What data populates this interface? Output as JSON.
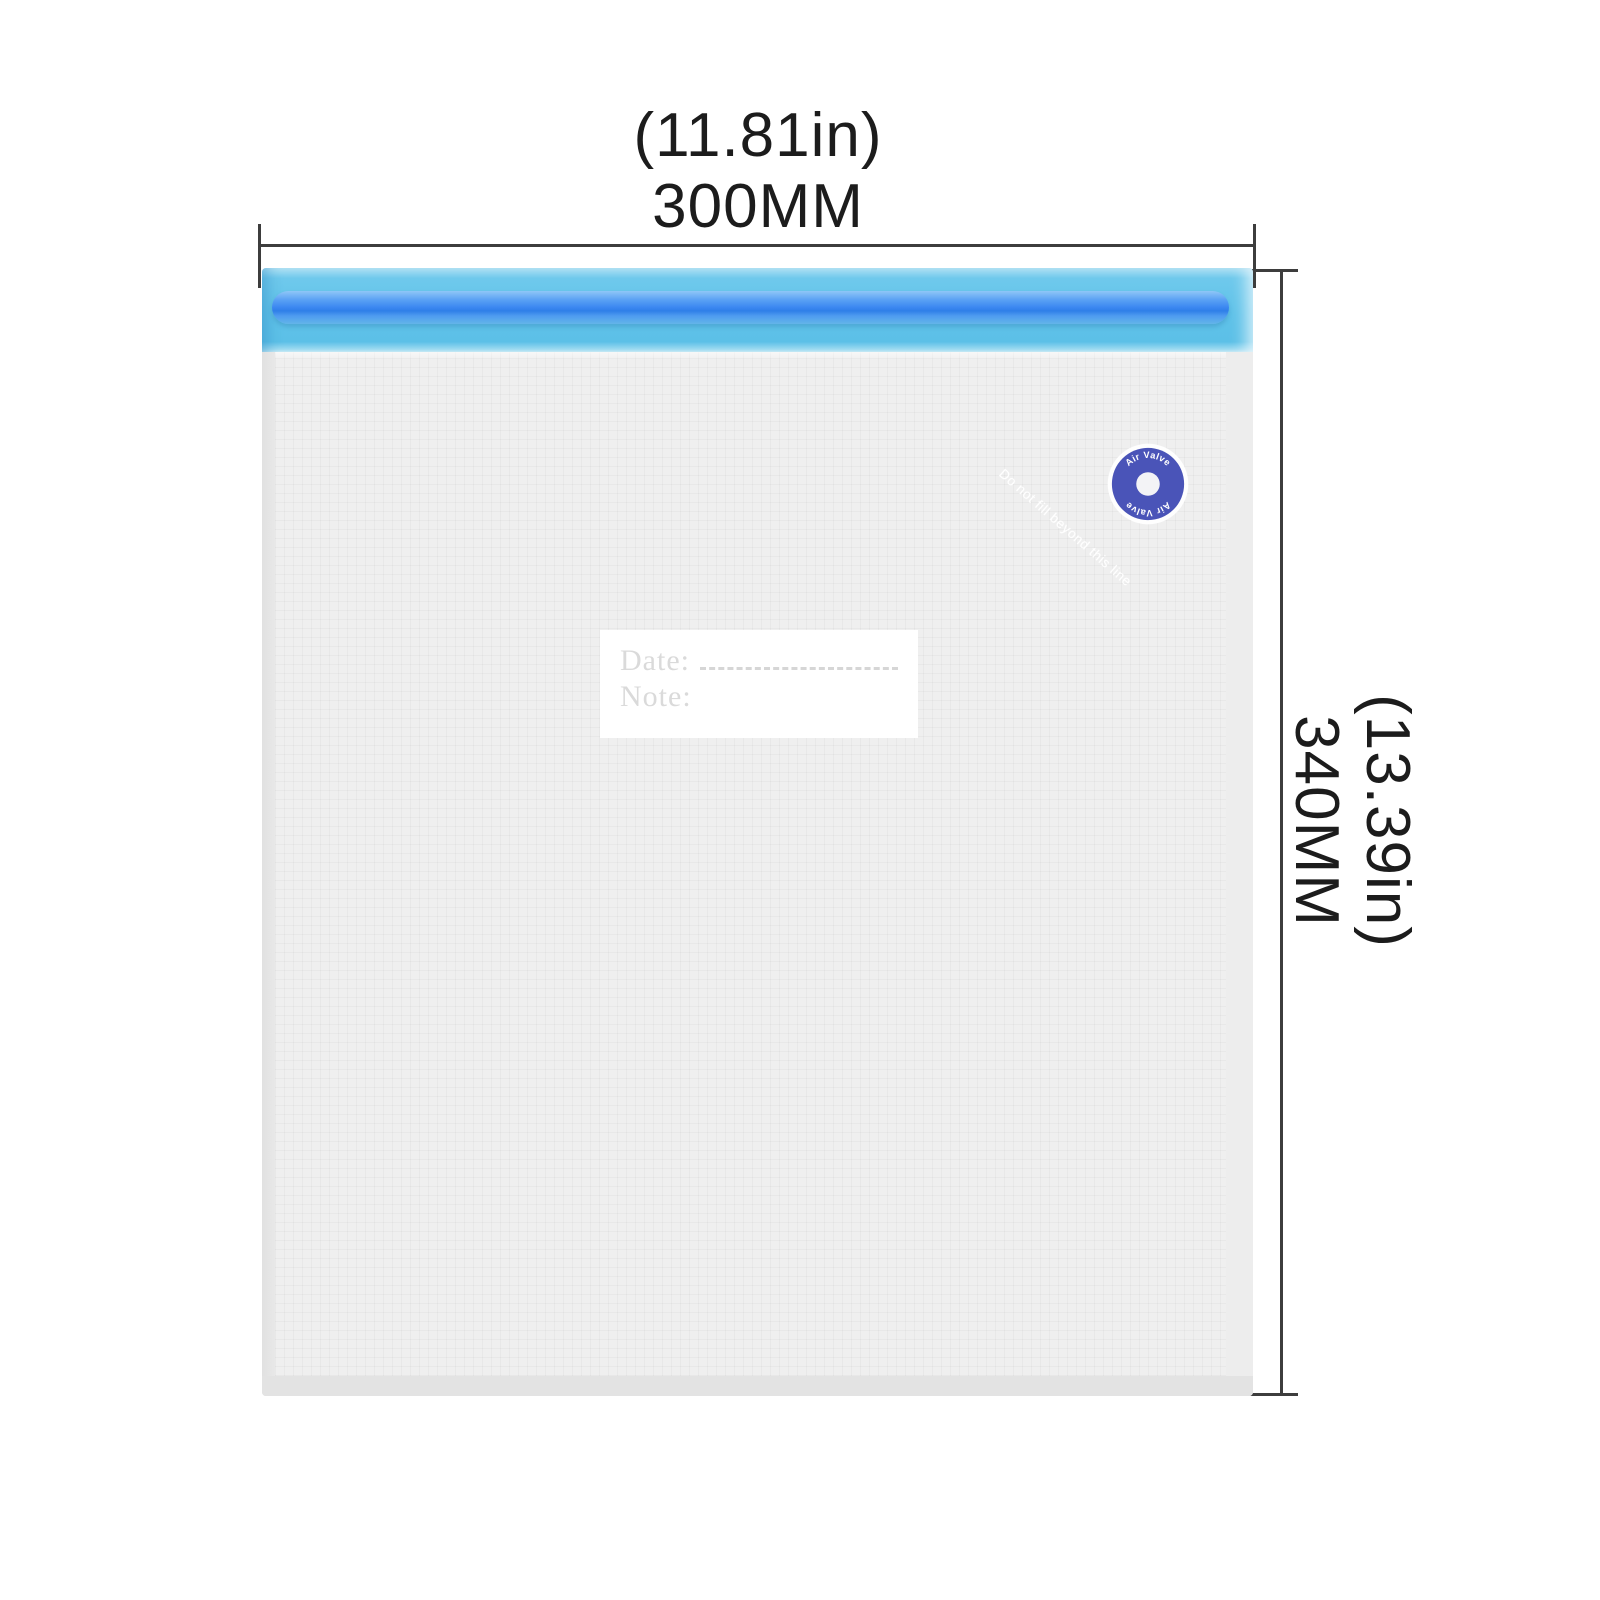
{
  "dimensions": {
    "width": {
      "inches": "(11.81in)",
      "mm": "300MM"
    },
    "height": {
      "inches": "(13.39in)",
      "mm": "340MM"
    }
  },
  "product": {
    "valve": {
      "label_top": "Air Valve",
      "label_bottom": "Air Valve"
    },
    "watermark": "Do not fill beyond this line",
    "label": {
      "date": "Date:",
      "note": "Note:"
    }
  },
  "colors": {
    "dimension_line": "#3d3d3d",
    "dimension_text": "#1c1c1c",
    "zipper_band_blue": "#5fc2e9",
    "zipper_rail_blue": "#3b87f1",
    "valve_blue": "#4a54b8",
    "bag_body_gray": "#efefef",
    "label_background": "#ffffff"
  }
}
